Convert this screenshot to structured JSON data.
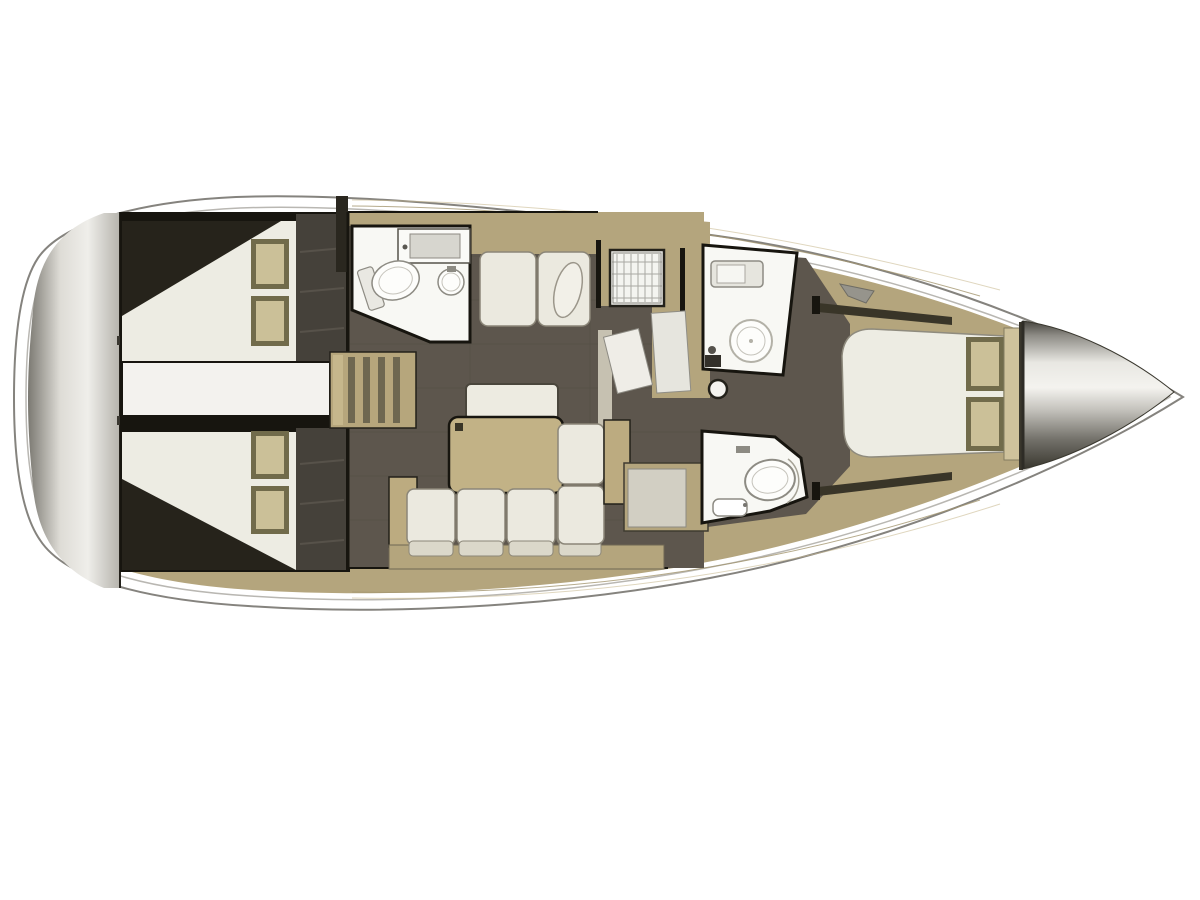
{
  "title": "sailing-yacht-interior-floor-plan-top-view",
  "canvas": {
    "width": 1200,
    "height": 900,
    "background": "#ffffff"
  },
  "palette": {
    "hull": "#ffffff",
    "hull-outline": "#85837e",
    "toe-rail": "#b9b7b2",
    "deck": "#b4a57d",
    "deck-seam": "#a4966f",
    "deck-seam-light": "#c9bb92",
    "floor": "#5d564d",
    "floor-seam": "#534d45",
    "wall": "#17150f",
    "mattress": "#edece3",
    "shadow-wedge": "#26231b",
    "wardrobe": "#45413a",
    "wardrobe-line": "#57524a",
    "bath": "#f8f8f4",
    "fixture": "#8d8b83",
    "fixture-light": "#c5c3bb",
    "cushion": "#ebe9df",
    "cushion-edge": "#8b8678",
    "cushion-lip": "#dbd8ca",
    "pillow-frame": "#716b4b",
    "pillow": "#cbc098",
    "ladder": "#b6a67c",
    "ladder-slat": "#6e6750",
    "table": "#c2b286",
    "counter-inset": "#d7d6cf",
    "cabinet-inset": "#d2cfc3",
    "galley-strip": "#c6c1b1",
    "stove-grid": "#a9a8a2",
    "trim-dark": "#393528",
    "hardware": "#96948c",
    "transom-gradient": [
      "#7b7972",
      "#dedcd6",
      "#efeeea",
      "#b5b3ac"
    ],
    "bow-cone-gradient": [
      "#45433d",
      "#8f8d87",
      "#e8e7e2",
      "#f4f3ef",
      "#c4c2bc",
      "#73716a",
      "#39372f"
    ]
  },
  "scene": {
    "orientation": "bow-right-stern-left",
    "rooms": [
      {
        "id": "stern-transom",
        "features": [
          "transom-band"
        ]
      },
      {
        "id": "aft-cabin-port",
        "features": [
          "double-berth",
          "pillow",
          "pillow",
          "wardrobe-locker"
        ]
      },
      {
        "id": "aft-cabin-starboard",
        "features": [
          "double-berth",
          "pillow",
          "pillow",
          "wardrobe-locker"
        ]
      },
      {
        "id": "engine-compartment",
        "features": [
          "engine-box"
        ]
      },
      {
        "id": "companionway",
        "features": [
          "ladder-steps"
        ]
      },
      {
        "id": "saloon",
        "features": [
          "port-settee",
          "dining-table",
          "bench-seat",
          "l-shaped-settee",
          "mast-post",
          "side-cabinet"
        ]
      },
      {
        "id": "galley",
        "features": [
          "stove-grid",
          "counter-sink",
          "worktop"
        ]
      },
      {
        "id": "head-aft-port",
        "features": [
          "toilet",
          "washbasin",
          "vanity-counter"
        ]
      },
      {
        "id": "head-forward-port",
        "features": [
          "shower",
          "vanity-counter"
        ]
      },
      {
        "id": "head-forward-starboard",
        "features": [
          "toilet-shower",
          "washbasin"
        ]
      },
      {
        "id": "forward-cabin",
        "features": [
          "island-double-berth",
          "pillow",
          "pillow",
          "headboard",
          "side-lockers"
        ]
      },
      {
        "id": "bow",
        "features": [
          "anchor-locker-cone"
        ]
      }
    ]
  }
}
